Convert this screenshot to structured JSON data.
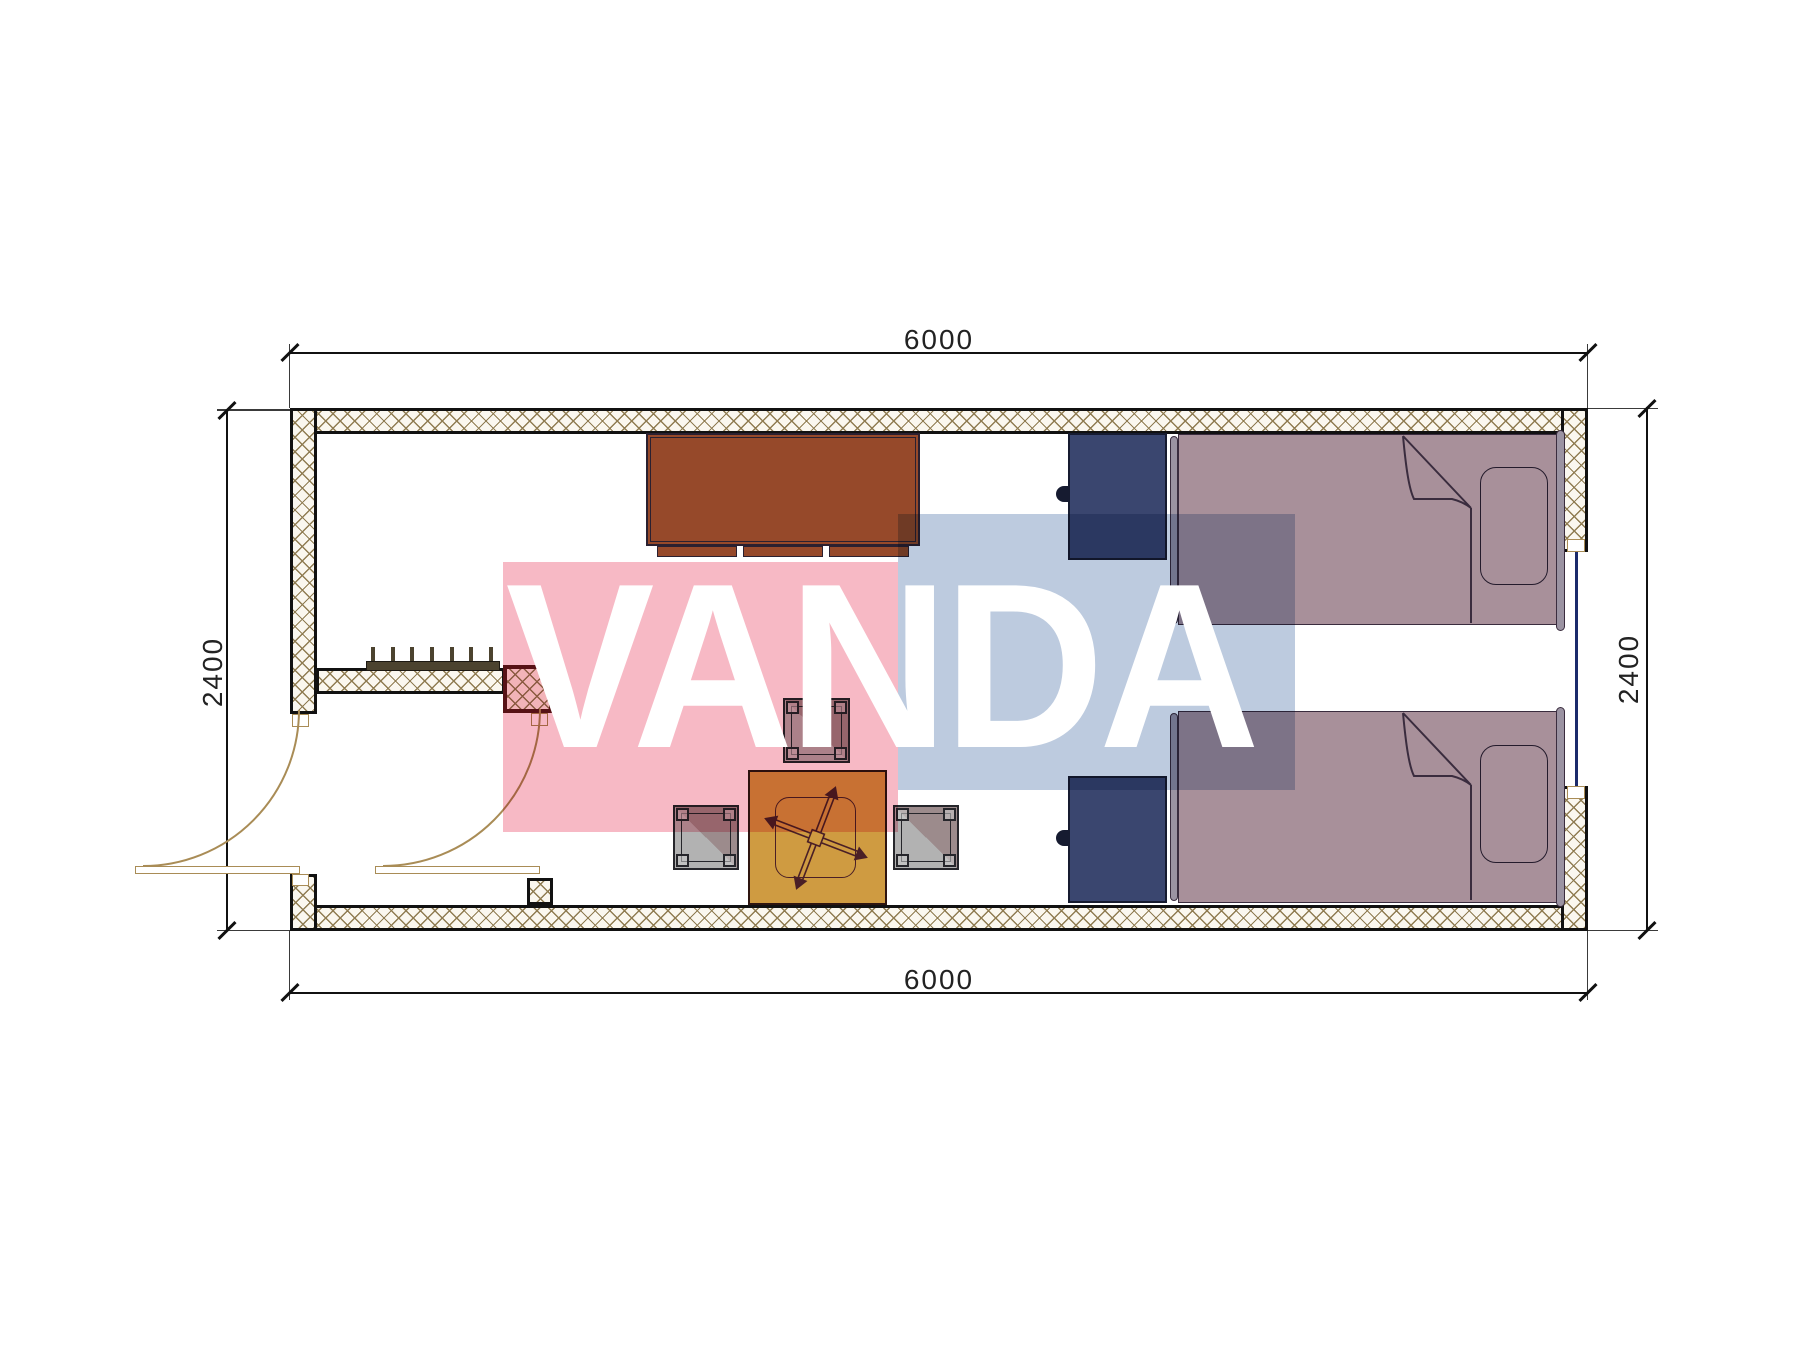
{
  "plan": {
    "dims": {
      "top": "6000",
      "bottom": "6000",
      "left": "2400",
      "right": "2400"
    },
    "watermark": {
      "text": "VANDA"
    },
    "colors": {
      "lineDark": "#111111",
      "dimText": "#222222",
      "hatchLine": "#8f7c52",
      "hatchBg": "#faf7ef",
      "maroon": "#5a181c",
      "tan": "#a98c56",
      "glazing": "#1b2a6b",
      "radiator": "#4c432f",
      "cabinet": "#96492a",
      "cabinetEdge": "#2a2030",
      "nightstand": "#3a466f",
      "nightstandEdge": "#161b30",
      "bedFill": "#a8909a",
      "bedBar": "#9b93a2",
      "bedEdge": "#3a2c3e",
      "pillowEdge": "#241b2c",
      "stoolDark": "#9c8b8c",
      "stoolLight": "#b2b2b2",
      "stoolEdge": "#26262b",
      "tableFill": "#cf9b41",
      "tableEdge": "#2e1510",
      "crossColor": "#4a1f26",
      "wmPink": "#f7b9c5",
      "wmBlue": "#bdcbdf",
      "wmText": "#ffffff"
    }
  }
}
